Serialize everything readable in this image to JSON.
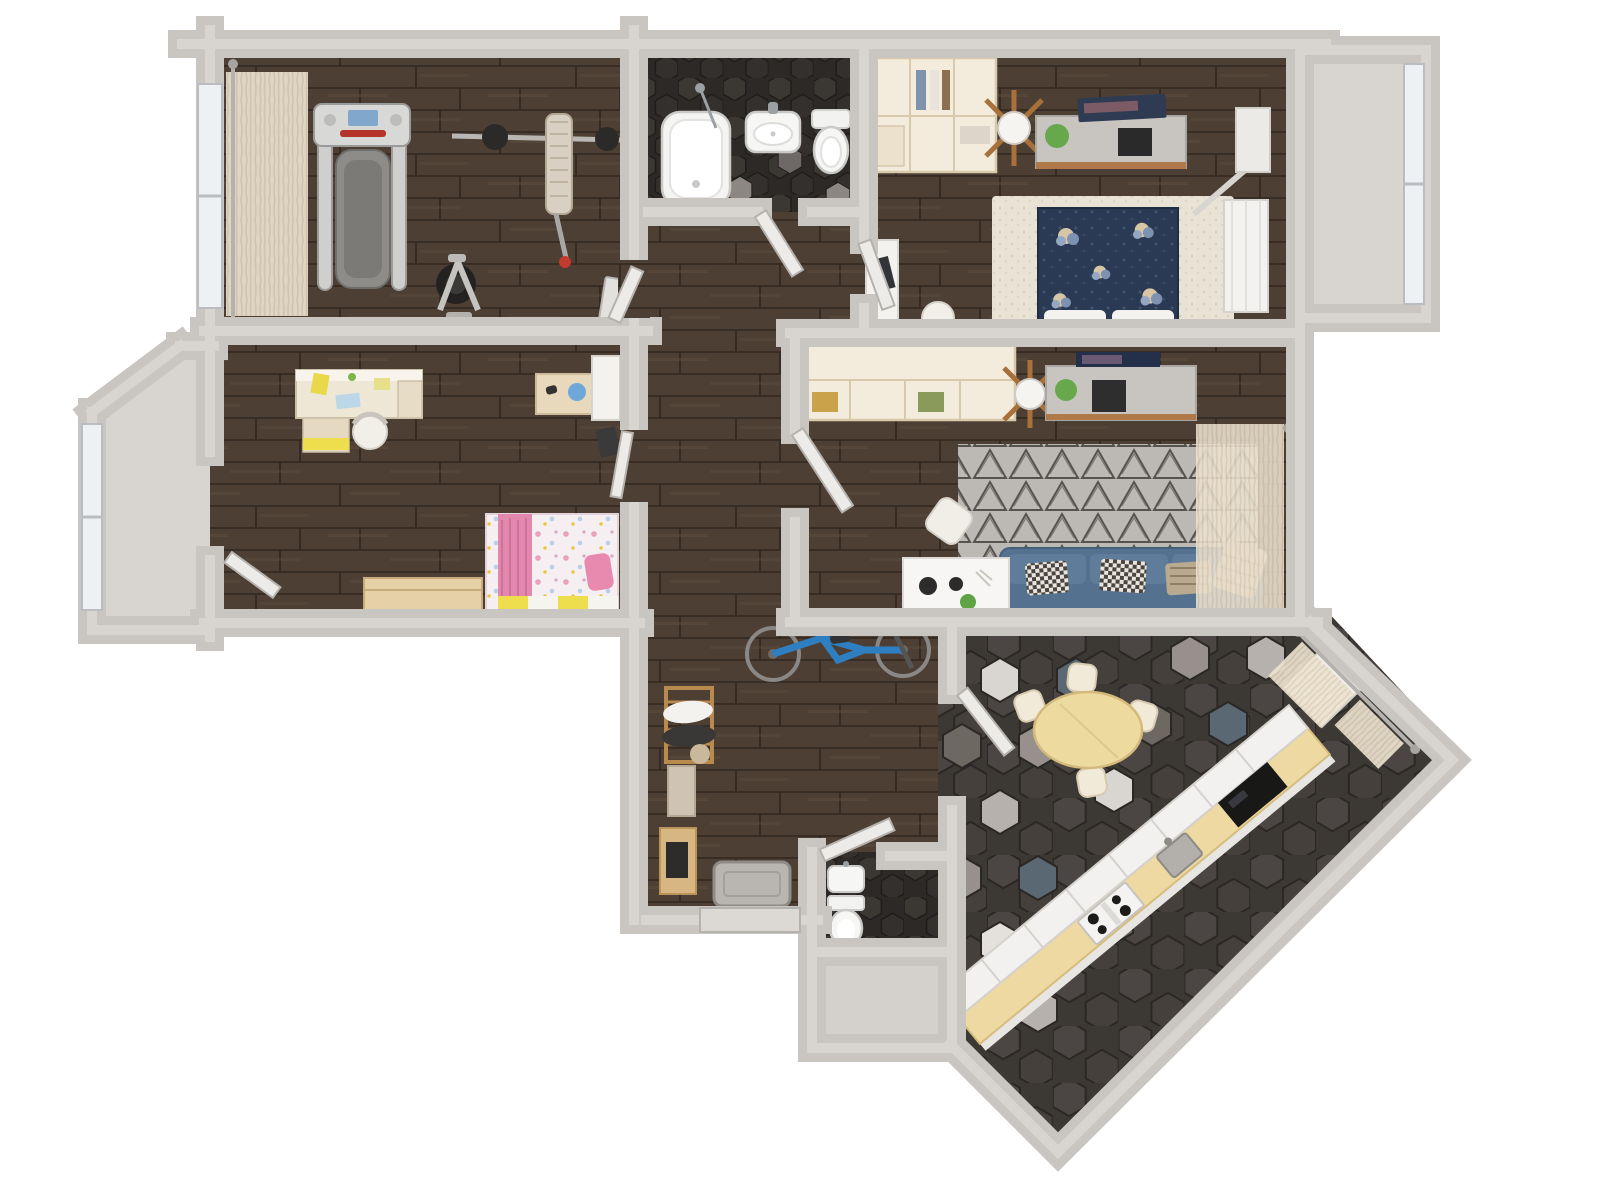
{
  "meta": {
    "type": "3d-floor-plan-render",
    "view": "top-down",
    "canvas_w": 1600,
    "canvas_h": 1200
  },
  "palette": {
    "wall": "#c9c5c1",
    "wall_light": "#d8d5d1",
    "wood_base": "#4d3f33",
    "wood_line": "#382d24",
    "wood_streak": "#5d4d3e",
    "tile_dark_bg": "#2c2927",
    "tile_dark_hex": "#3b3733",
    "tile_mix_bg": "#3c3834",
    "tile_mix_hex": "#4b4643",
    "floor_gray": "#d8d5d1",
    "curtain": "#ece2d0",
    "sofa": "#54718f",
    "sofa_cushion": "#5f7d9b",
    "bed_navy": "#2b3a54",
    "rug_living": "#bcb8b3",
    "rug_triangle": "#56524e",
    "rug_bedroom": "#e9e3d6",
    "pink": "#e287ad",
    "pink_light": "#f5ebf0",
    "yellow": "#eede4d",
    "kids_wood": "#e6d0a8",
    "cream": "#f3ebdb",
    "counter_wood": "#eed9a2",
    "table_wood": "#edda9f",
    "bike_blue": "#2e7fc2",
    "appliance_dark": "#181817",
    "white_furniture": "#f5f4f2",
    "gray_cabinet": "#c8c5c1",
    "plant_green": "#67a84c",
    "lamp_wood": "#a8713b",
    "window_glass": "#eef1f3"
  },
  "rooms": [
    {
      "id": "gym",
      "label": "Fitness room",
      "floor": "dark wood planks",
      "furniture": [
        "treadmill",
        "barbell-rack",
        "weight-bench",
        "exercise-bike",
        "sheer-curtain",
        "window"
      ]
    },
    {
      "id": "bathroom",
      "label": "Bathroom",
      "floor": "dark hex tile",
      "furniture": [
        "bathtub",
        "washbasin",
        "toilet"
      ]
    },
    {
      "id": "bedroom",
      "label": "Bedroom",
      "floor": "dark wood planks",
      "furniture": [
        "open-wardrobe",
        "floor-lamp",
        "media-cabinet",
        "laptop",
        "plant",
        "double-bed-navy",
        "area-rug",
        "desk",
        "chair",
        "wardrobe",
        "curtain-rod"
      ]
    },
    {
      "id": "kids-room",
      "label": "Kids bedroom",
      "floor": "dark wood planks",
      "furniture": [
        "desk",
        "desk-chair",
        "wall-shelf",
        "globe",
        "single-bed-pink",
        "toy-chest",
        "door-to-balcony"
      ]
    },
    {
      "id": "living-room",
      "label": "Living room",
      "floor": "dark wood planks",
      "furniture": [
        "sideboard",
        "floor-lamp",
        "computer-desk",
        "monitor",
        "geometric-rug",
        "sofa-blue",
        "pillows",
        "coffee-desk",
        "chair",
        "sheer-curtain"
      ]
    },
    {
      "id": "hallway",
      "label": "Hallway",
      "floor": "dark wood planks",
      "furniture": [
        "bicycle",
        "coat-rack",
        "shoe-cabinet",
        "bench",
        "door-mat",
        "entry-door"
      ]
    },
    {
      "id": "wc",
      "label": "Toilet room",
      "floor": "dark hex tile",
      "furniture": [
        "washbasin",
        "toilet"
      ]
    },
    {
      "id": "lobby",
      "label": "Entry lobby",
      "floor": "gray screed",
      "furniture": []
    },
    {
      "id": "kitchen",
      "label": "Kitchen dining room",
      "floor": "mixed hex tile",
      "furniture": [
        "dining-table",
        "dining-chairs",
        "kitchen-counter",
        "gas-hob",
        "sink",
        "black-appliance",
        "fridge",
        "sheer-curtain"
      ]
    },
    {
      "id": "balcony-left",
      "label": "Bay window left",
      "floor": "gray screed",
      "furniture": [
        "window"
      ]
    },
    {
      "id": "balcony-right",
      "label": "Bay window right",
      "floor": "gray screed",
      "furniture": [
        "window"
      ]
    }
  ]
}
